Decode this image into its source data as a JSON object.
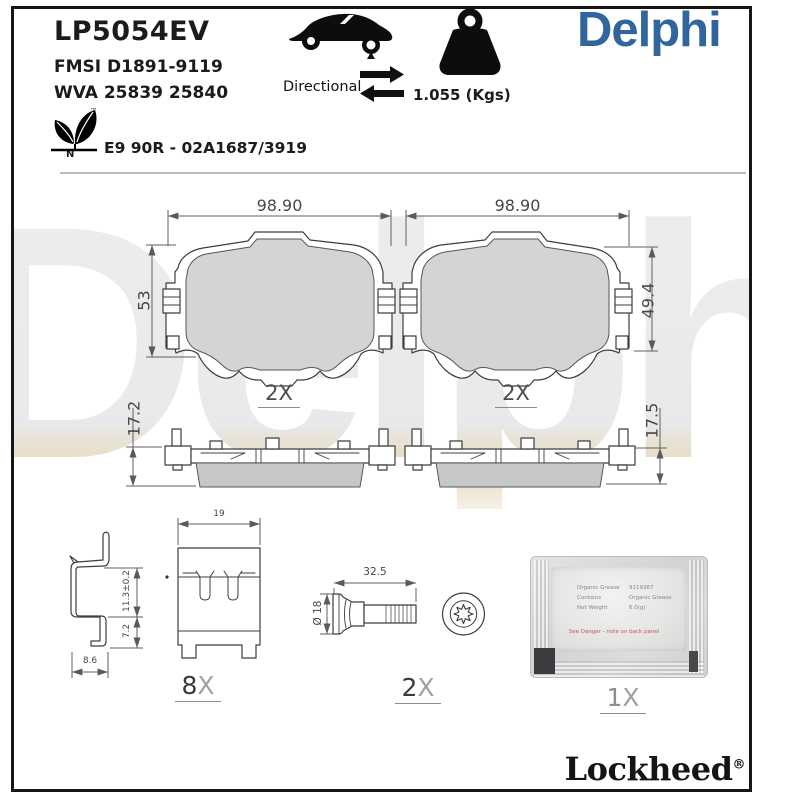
{
  "header": {
    "part_number": "LP5054EV",
    "fmsi": "FMSI D1891-9119",
    "wva": "WVA 25839 25840",
    "directional": "Directional",
    "weight": "1.055 (Kgs)",
    "brand": "Delphi",
    "leaf_tm": "™",
    "leaf_n": "N",
    "approval": "E9 90R - 02A1687/3919"
  },
  "icons": {
    "car": "car-silhouette-icon",
    "directional": "directional-arrows-icon",
    "weight": "weight-icon",
    "leaf": "eco-leaf-icon"
  },
  "drawings": {
    "pad_front_left": {
      "width": "98.90",
      "height": "53",
      "qty": "2X"
    },
    "pad_front_right": {
      "width": "98.90",
      "height": "49.4",
      "qty": "2X"
    },
    "pad_side_left": {
      "thickness": "17.2"
    },
    "pad_side_right": {
      "thickness": "17.5"
    },
    "clip": {
      "width": "19",
      "upper": "11.3±0.2",
      "lower": "7.2",
      "foot": "8.6",
      "qty_num": "8",
      "qty_x": "X"
    },
    "bolt": {
      "length": "32.5",
      "diameter": "Ø 18",
      "qty_num": "2",
      "qty_x": "X"
    },
    "grease": {
      "qty_num": "1",
      "qty_x": "X",
      "left": [
        "Organic Grease",
        "Contains",
        "Net Weight"
      ],
      "right": [
        "9119367",
        "Organic Grease",
        "6.0(g)"
      ],
      "warning": "See Danger - note on back panel"
    }
  },
  "footer": {
    "brand": "Lockheed",
    "reg": "®"
  },
  "watermark": "Delphi",
  "colors": {
    "brand_blue": "#30659E",
    "friction_gray": "#d3d4d6"
  }
}
